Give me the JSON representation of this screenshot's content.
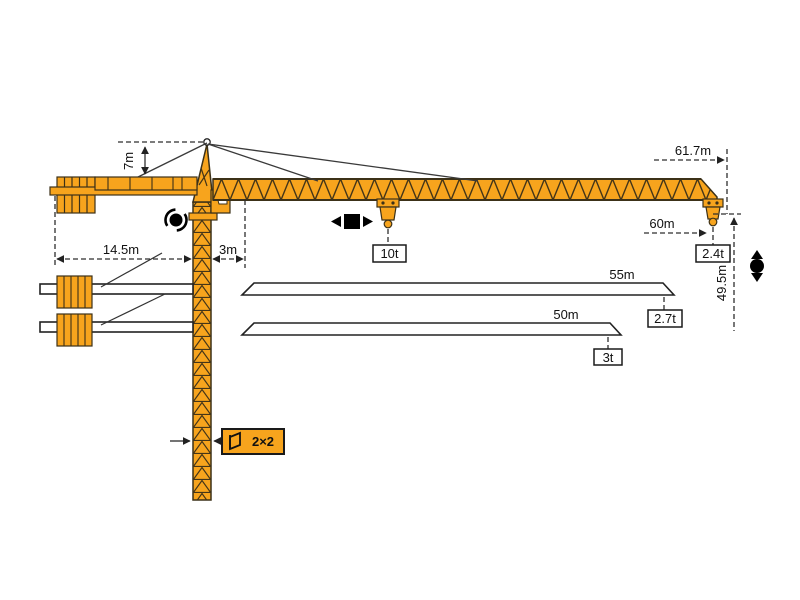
{
  "diagram": {
    "type": "tower-crane-specification-diagram",
    "colors": {
      "crane_orange": "#F7A41D",
      "line_dark": "#2e2e2e",
      "background": "#ffffff"
    },
    "dimensions": {
      "head_height": "7m",
      "counter_jib_length": "14.5m",
      "jib_root_offset": "3m",
      "max_working_radius": "61.7m",
      "radius_at_tip_load": "60m",
      "height_under_hook": "49.5m",
      "mast_section": "2×2"
    },
    "loads": {
      "max_capacity": "10t",
      "tip_load_max_radius": "2.4t"
    },
    "jib_options": [
      {
        "length": "55m",
        "tip_load": "2.7t"
      },
      {
        "length": "50m",
        "tip_load": "3t"
      }
    ],
    "icons": {
      "slew": "slew-rotation-icon",
      "trolley": "trolley-travel-icon",
      "hoist": "hoist-icon",
      "mast_section": "mast-section-icon"
    }
  }
}
